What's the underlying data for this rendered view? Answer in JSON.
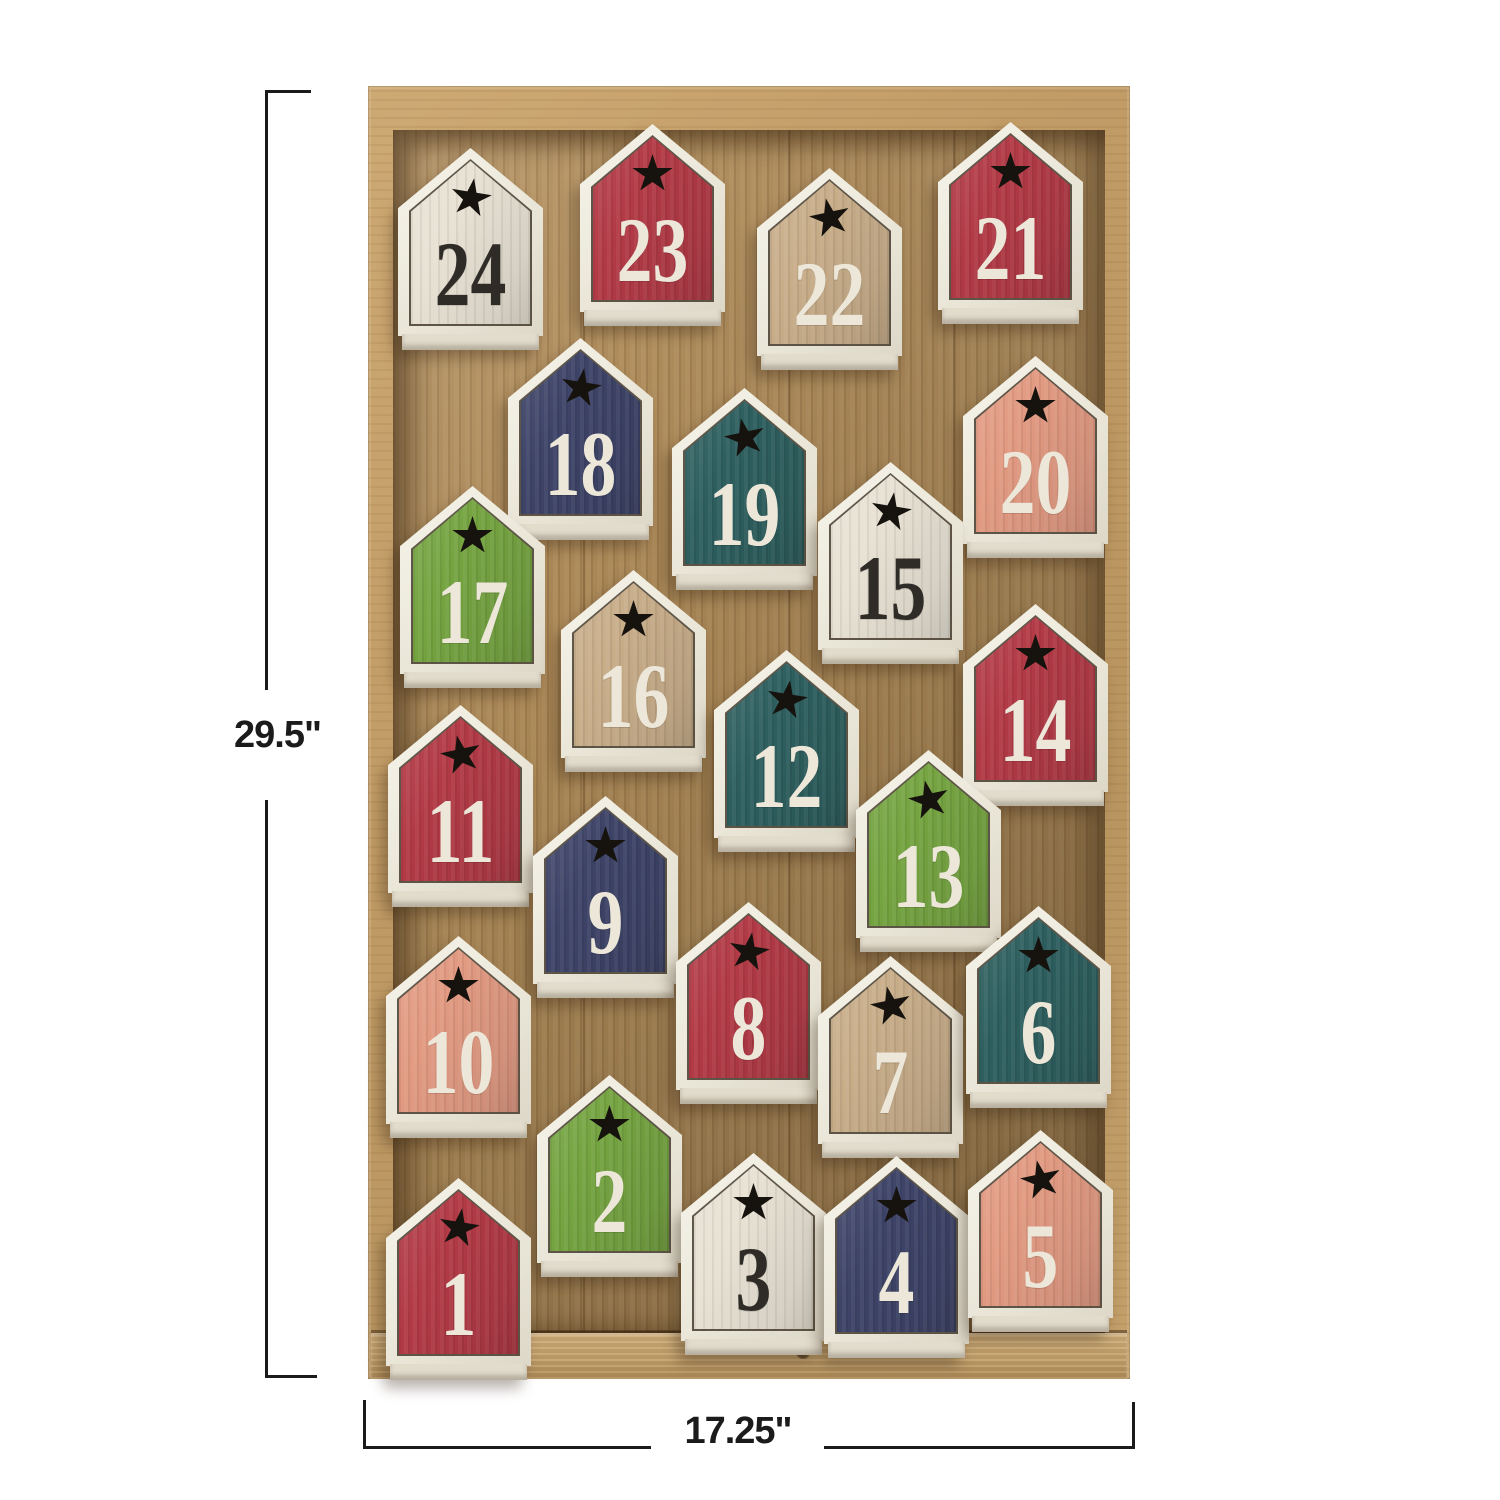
{
  "image": {
    "type": "product-photo",
    "subject": "Wooden advent calendar: natural wood tray holding 24 house-shaped numbered blocks with star cutouts"
  },
  "dimension_annotations": {
    "height_label": "29.5\"",
    "width_label": "17.25\""
  },
  "colors": {
    "background": "#ffffff",
    "dimension_lines": "#1b1b1b",
    "tray_frame": "#c29c66",
    "tray_floor": "#a98655",
    "tray_rim": "#c3a06a",
    "house_frame": "#efece1",
    "star": "#16120e",
    "number_light": "#ece7d9",
    "number_dark": "#2f2c28",
    "house_fills": {
      "red": "#b23a46",
      "navy": "#3e4468",
      "teal": "#2e5f5f",
      "green": "#75a441",
      "pink": "#e29a82",
      "tan": "#c8ad89",
      "white": "#e8e2d4"
    }
  },
  "houses": [
    {
      "number": "24",
      "color": "white",
      "x": 398,
      "y": 148
    },
    {
      "number": "23",
      "color": "red",
      "x": 580,
      "y": 124
    },
    {
      "number": "22",
      "color": "tan",
      "x": 757,
      "y": 168
    },
    {
      "number": "21",
      "color": "red",
      "x": 938,
      "y": 122
    },
    {
      "number": "18",
      "color": "navy",
      "x": 508,
      "y": 338
    },
    {
      "number": "19",
      "color": "teal",
      "x": 672,
      "y": 388
    },
    {
      "number": "20",
      "color": "pink",
      "x": 963,
      "y": 356
    },
    {
      "number": "17",
      "color": "green",
      "x": 400,
      "y": 486
    },
    {
      "number": "15",
      "color": "white",
      "x": 818,
      "y": 462
    },
    {
      "number": "16",
      "color": "tan",
      "x": 561,
      "y": 570
    },
    {
      "number": "14",
      "color": "red",
      "x": 963,
      "y": 604
    },
    {
      "number": "11",
      "color": "red",
      "x": 388,
      "y": 705
    },
    {
      "number": "12",
      "color": "teal",
      "x": 714,
      "y": 650
    },
    {
      "number": "9",
      "color": "navy",
      "x": 533,
      "y": 796
    },
    {
      "number": "13",
      "color": "green",
      "x": 856,
      "y": 750
    },
    {
      "number": "10",
      "color": "pink",
      "x": 386,
      "y": 936
    },
    {
      "number": "8",
      "color": "red",
      "x": 676,
      "y": 902
    },
    {
      "number": "7",
      "color": "tan",
      "x": 818,
      "y": 956
    },
    {
      "number": "6",
      "color": "teal",
      "x": 966,
      "y": 906
    },
    {
      "number": "2",
      "color": "green",
      "x": 537,
      "y": 1075
    },
    {
      "number": "1",
      "color": "red",
      "x": 386,
      "y": 1178
    },
    {
      "number": "3",
      "color": "white",
      "x": 681,
      "y": 1153
    },
    {
      "number": "4",
      "color": "navy",
      "x": 824,
      "y": 1156
    },
    {
      "number": "5",
      "color": "pink",
      "x": 968,
      "y": 1130
    }
  ]
}
